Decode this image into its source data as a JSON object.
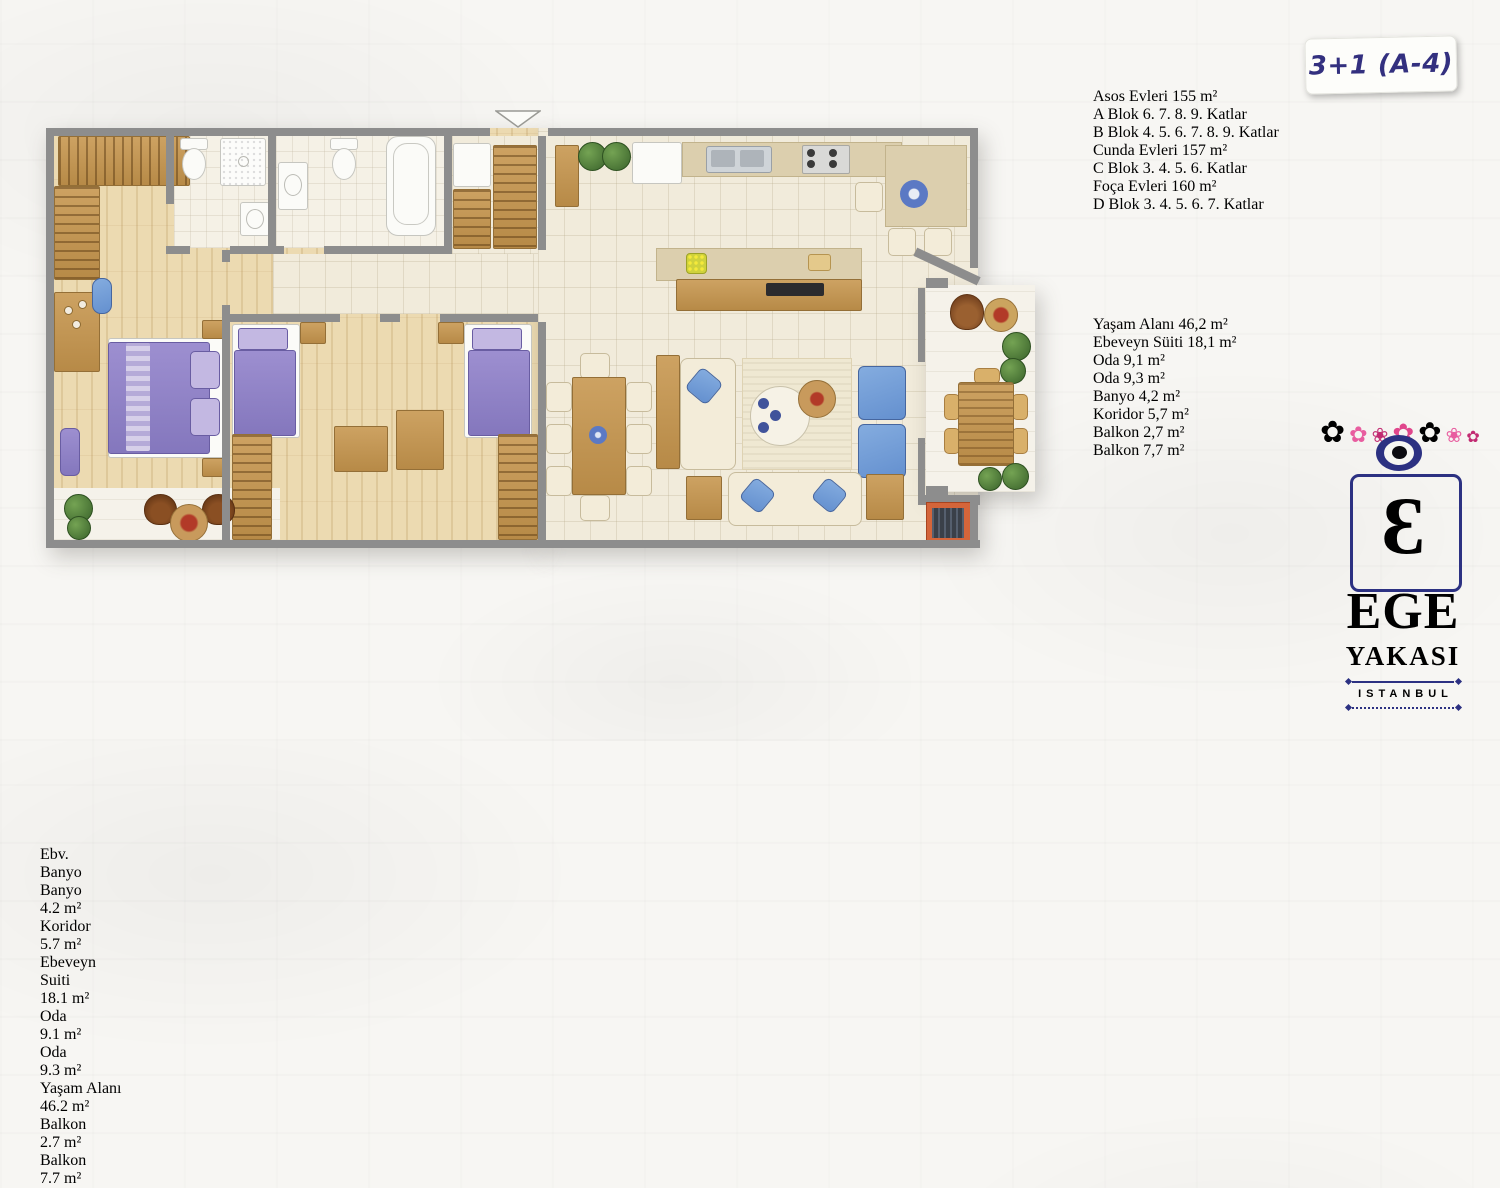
{
  "badge": {
    "label": "3+1 (A-4)"
  },
  "info": {
    "lines": [
      "Asos Evleri 155 m²",
      "A Blok 6. 7. 8. 9. Katlar",
      "B Blok 4. 5. 6. 7. 8. 9. Katlar",
      "Cunda Evleri 157 m²",
      "C Blok 3. 4. 5. 6. Katlar",
      "Foça Evleri 160 m²",
      "D Blok 3. 4. 5. 6. 7. Katlar"
    ],
    "room_list": [
      "Yaşam Alanı 46,2 m²",
      "Ebeveyn Süiti 18,1 m²",
      "Oda 9,1 m²",
      "Oda 9,3 m²",
      "Banyo 4,2 m²",
      "Koridor 5,7 m²",
      "Balkon 2,7 m²",
      "Balkon 7,7 m²"
    ]
  },
  "plan": {
    "labels": {
      "ebv_banyo": {
        "line1": "Ebv.",
        "line2": "Banyo"
      },
      "banyo": {
        "name": "Banyo",
        "area": "4.2 m²"
      },
      "koridor": {
        "name": "Koridor",
        "area": "5.7 m²"
      },
      "ebeveyn": {
        "line1": "Ebeveyn",
        "line2": "Suiti",
        "area": "18.1 m²"
      },
      "oda_1": {
        "name": "Oda",
        "area": "9.1 m²"
      },
      "oda_2": {
        "name": "Oda",
        "area": "9.3 m²"
      },
      "yasam": {
        "name": "Yaşam Alanı",
        "area": "46.2 m²"
      },
      "balkon_kucuk": {
        "name": "Balkon",
        "area": "2.7 m²"
      },
      "balkon_buyuk": {
        "name": "Balkon",
        "area": "7.7 m²"
      }
    }
  },
  "logo": {
    "monogram": "Ɛ",
    "name_line1": "EGE",
    "name_line2": "YAKASI",
    "name_line3": "ISTANBUL"
  },
  "colors": {
    "navy": "#2c3182",
    "pink": "#d93884",
    "wall_gray": "#8d8d8d",
    "wood": "#c49a5c",
    "purple": "#9184c8",
    "blue": "#6f9bd9",
    "cream_sofa": "#f3ecd9",
    "teal_glass": "#4fb6c6"
  }
}
